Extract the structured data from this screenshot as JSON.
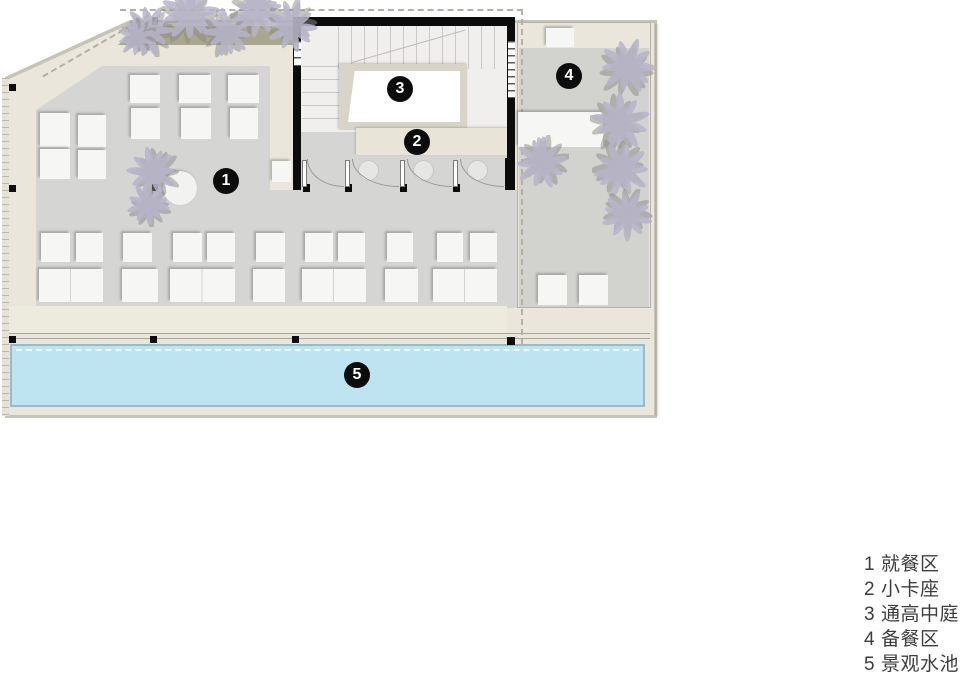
{
  "title": "restaurant-floor-plan",
  "colors": {
    "background": "#ffffff",
    "walkway_beige": "#eae6db",
    "floor_grey": "#d5d5d3",
    "pool_blue": "#bee3f1",
    "wall_black": "#0c0c0c",
    "planter_olive": "#949278",
    "tree_lavender": "#b7b4c9",
    "legend_ink": "#3d3d3d"
  },
  "badges": [
    {
      "num": "1",
      "x": 226,
      "y": 181
    },
    {
      "num": "2",
      "x": 417,
      "y": 142
    },
    {
      "num": "3",
      "x": 400,
      "y": 89
    },
    {
      "num": "4",
      "x": 569,
      "y": 76
    },
    {
      "num": "5",
      "x": 357,
      "y": 375
    }
  ],
  "legend": {
    "items": [
      {
        "num": "1",
        "label": "就餐区"
      },
      {
        "num": "2",
        "label": "小卡座"
      },
      {
        "num": "3",
        "label": "通高中庭"
      },
      {
        "num": "4",
        "label": "备餐区"
      },
      {
        "num": "5",
        "label": "景观水池"
      }
    ]
  },
  "furniture": {
    "tables": [
      [
        40,
        113,
        30,
        34
      ],
      [
        78,
        115,
        28,
        32
      ],
      [
        40,
        149,
        30,
        30
      ],
      [
        78,
        150,
        28,
        29
      ],
      [
        130,
        75,
        30,
        28
      ],
      [
        131,
        108,
        29,
        31
      ],
      [
        179,
        75,
        32,
        28
      ],
      [
        181,
        108,
        30,
        31
      ],
      [
        228,
        75,
        31,
        28
      ],
      [
        230,
        108,
        28,
        31
      ],
      [
        41,
        233,
        29,
        29
      ],
      [
        76,
        233,
        27,
        29
      ],
      [
        123,
        233,
        29,
        29
      ],
      [
        173,
        233,
        29,
        29
      ],
      [
        207,
        233,
        28,
        29
      ],
      [
        256,
        233,
        29,
        29
      ],
      [
        305,
        233,
        28,
        29
      ],
      [
        338,
        233,
        27,
        29
      ],
      [
        387,
        233,
        26,
        29
      ],
      [
        437,
        233,
        26,
        29
      ],
      [
        470,
        233,
        27,
        29
      ],
      [
        122,
        269,
        36,
        33
      ],
      [
        253,
        269,
        32,
        33
      ],
      [
        385,
        269,
        33,
        33
      ],
      [
        538,
        275,
        29,
        30
      ],
      [
        579,
        275,
        29,
        30
      ],
      [
        518,
        112,
        85,
        35
      ],
      [
        546,
        28,
        28,
        19
      ],
      [
        272,
        161,
        19,
        21
      ]
    ],
    "pairs": [
      [
        39,
        269,
        64,
        33
      ],
      [
        170,
        269,
        65,
        33
      ],
      [
        302,
        269,
        64,
        33
      ],
      [
        433,
        269,
        64,
        33
      ]
    ],
    "round_tables": [
      {
        "cx": 180,
        "cy": 188,
        "d": 34
      }
    ],
    "bay_tables": [
      {
        "cx": 368,
        "cy": 170,
        "d": 21
      },
      {
        "cx": 423,
        "cy": 170,
        "d": 21
      },
      {
        "cx": 477,
        "cy": 170,
        "d": 21
      }
    ],
    "columns": [
      [
        9,
        84,
        7,
        7
      ],
      [
        9,
        185,
        7,
        7
      ],
      [
        9,
        336,
        7,
        7
      ],
      [
        150,
        336,
        7,
        7
      ],
      [
        292,
        336,
        7,
        7
      ],
      [
        507,
        337,
        8,
        8
      ],
      [
        152,
        17,
        6,
        8
      ],
      [
        152,
        184,
        6,
        7
      ],
      [
        303,
        184,
        7,
        8
      ],
      [
        345,
        184,
        7,
        8
      ],
      [
        400,
        184,
        7,
        8
      ],
      [
        453,
        184,
        7,
        8
      ],
      [
        505,
        158,
        10,
        32
      ]
    ],
    "posts": [
      [
        302,
        160,
        5,
        27
      ],
      [
        345,
        160,
        5,
        27
      ],
      [
        400,
        160,
        5,
        27
      ],
      [
        453,
        160,
        5,
        27
      ]
    ],
    "arcs": [
      [
        307,
        159,
        36,
        27
      ],
      [
        352,
        159,
        46,
        27
      ],
      [
        407,
        159,
        44,
        27
      ],
      [
        460,
        159,
        43,
        27
      ]
    ],
    "trees": [
      {
        "x": 148,
        "y": 30,
        "r": 27
      },
      {
        "x": 190,
        "y": 13,
        "r": 31
      },
      {
        "x": 228,
        "y": 32,
        "r": 26
      },
      {
        "x": 258,
        "y": 11,
        "r": 28
      },
      {
        "x": 292,
        "y": 27,
        "r": 27
      },
      {
        "x": 136,
        "y": 38,
        "r": 20
      },
      {
        "x": 152,
        "y": 172,
        "r": 27
      },
      {
        "x": 148,
        "y": 204,
        "r": 23
      },
      {
        "x": 628,
        "y": 66,
        "r": 30
      },
      {
        "x": 621,
        "y": 122,
        "r": 31
      },
      {
        "x": 622,
        "y": 170,
        "r": 30
      },
      {
        "x": 627,
        "y": 216,
        "r": 27
      },
      {
        "x": 541,
        "y": 163,
        "r": 28
      }
    ]
  }
}
